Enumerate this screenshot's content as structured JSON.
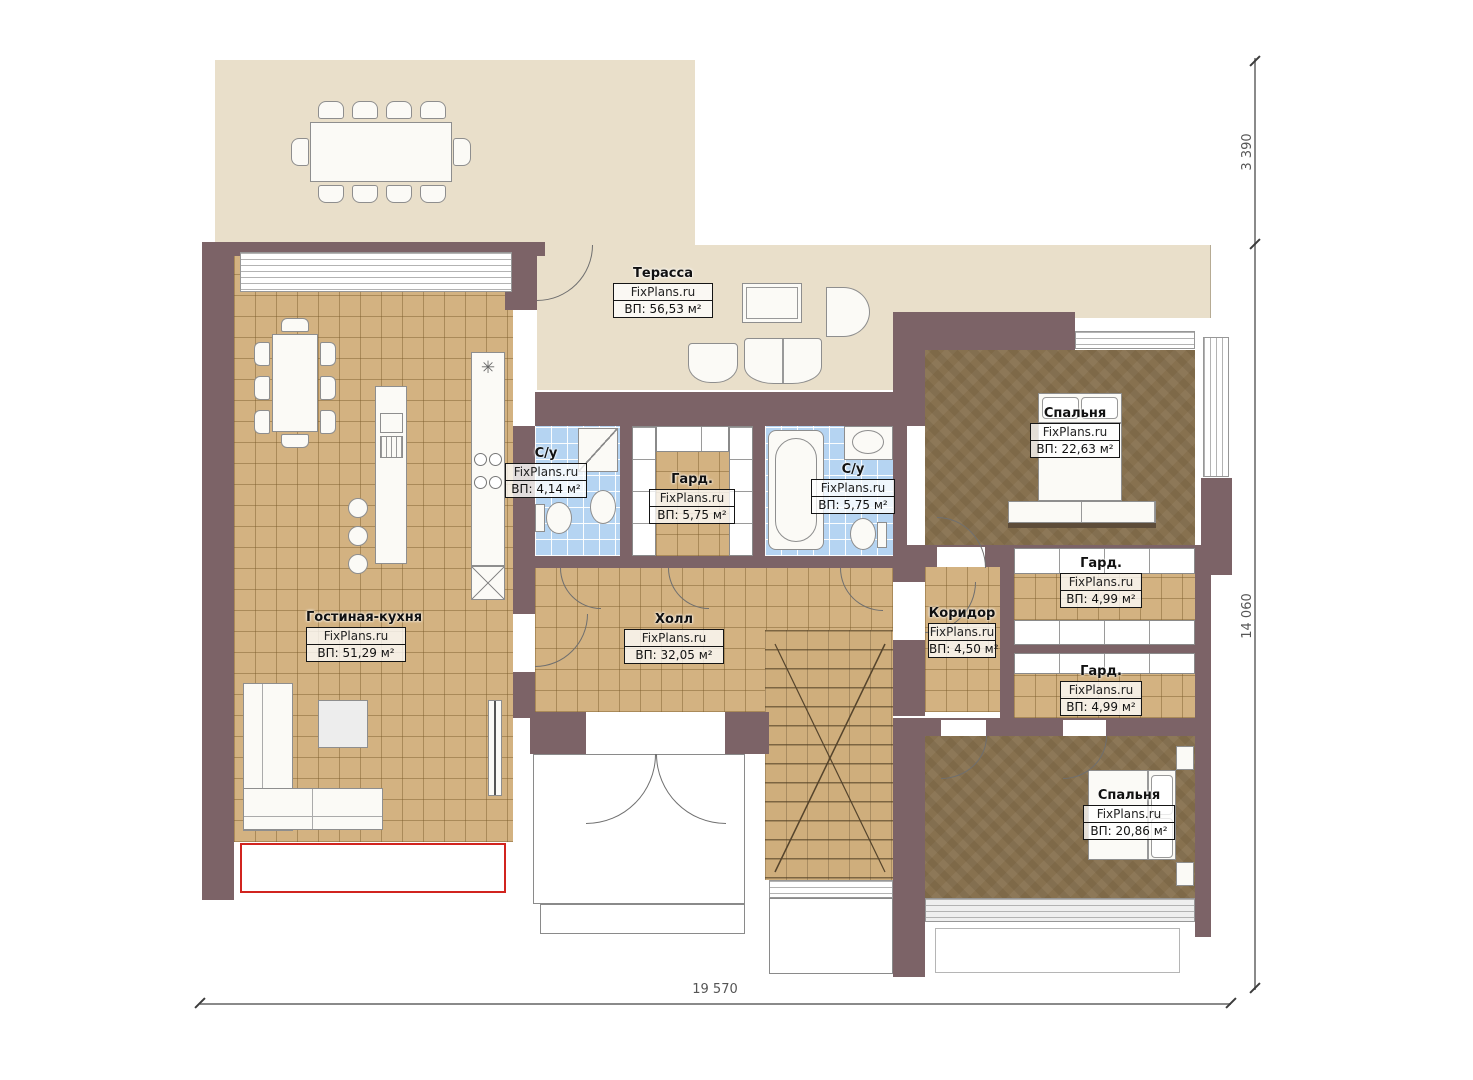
{
  "plan": {
    "watermark": "FixPlans.ru",
    "rooms": {
      "terrace": {
        "name": "Терасса",
        "area": "ВП: 56,53 м²"
      },
      "living_kitchen": {
        "name": "Гостиная-кухня",
        "area": "ВП: 51,29 м²"
      },
      "hall": {
        "name": "Холл",
        "area": "ВП: 32,05 м²"
      },
      "bathroom_small": {
        "name": "С/у",
        "area": "ВП: 4,14 м²"
      },
      "wardrobe_center": {
        "name": "Гард.",
        "area": "ВП: 5,75 м²"
      },
      "bathroom_main": {
        "name": "С/у",
        "area": "ВП: 5,75 м²"
      },
      "bedroom_top": {
        "name": "Спальня",
        "area": "ВП: 22,63 м²"
      },
      "corridor": {
        "name": "Коридор",
        "area": "ВП: 4,50 м²"
      },
      "wardrobe_right_top": {
        "name": "Гард.",
        "area": "ВП: 4,99 м²"
      },
      "wardrobe_right_bottom": {
        "name": "Гард.",
        "area": "ВП: 4,99 м²"
      },
      "bedroom_bottom": {
        "name": "Спальня",
        "area": "ВП: 20,86 м²"
      }
    },
    "dimensions": {
      "top_right": "3 390",
      "right_side": "14 060",
      "bottom": "19 570"
    },
    "symbols": {
      "kitchen_star": "✳"
    },
    "colors": {
      "wall": "#7c6367",
      "floor_tile": "#d3b281",
      "floor_bedroom": "#87714f",
      "floor_terrace": "#e9dfca",
      "bath_tile": "#b5d4f2",
      "accent_red": "#d1241f",
      "dimension": "#555555"
    }
  }
}
